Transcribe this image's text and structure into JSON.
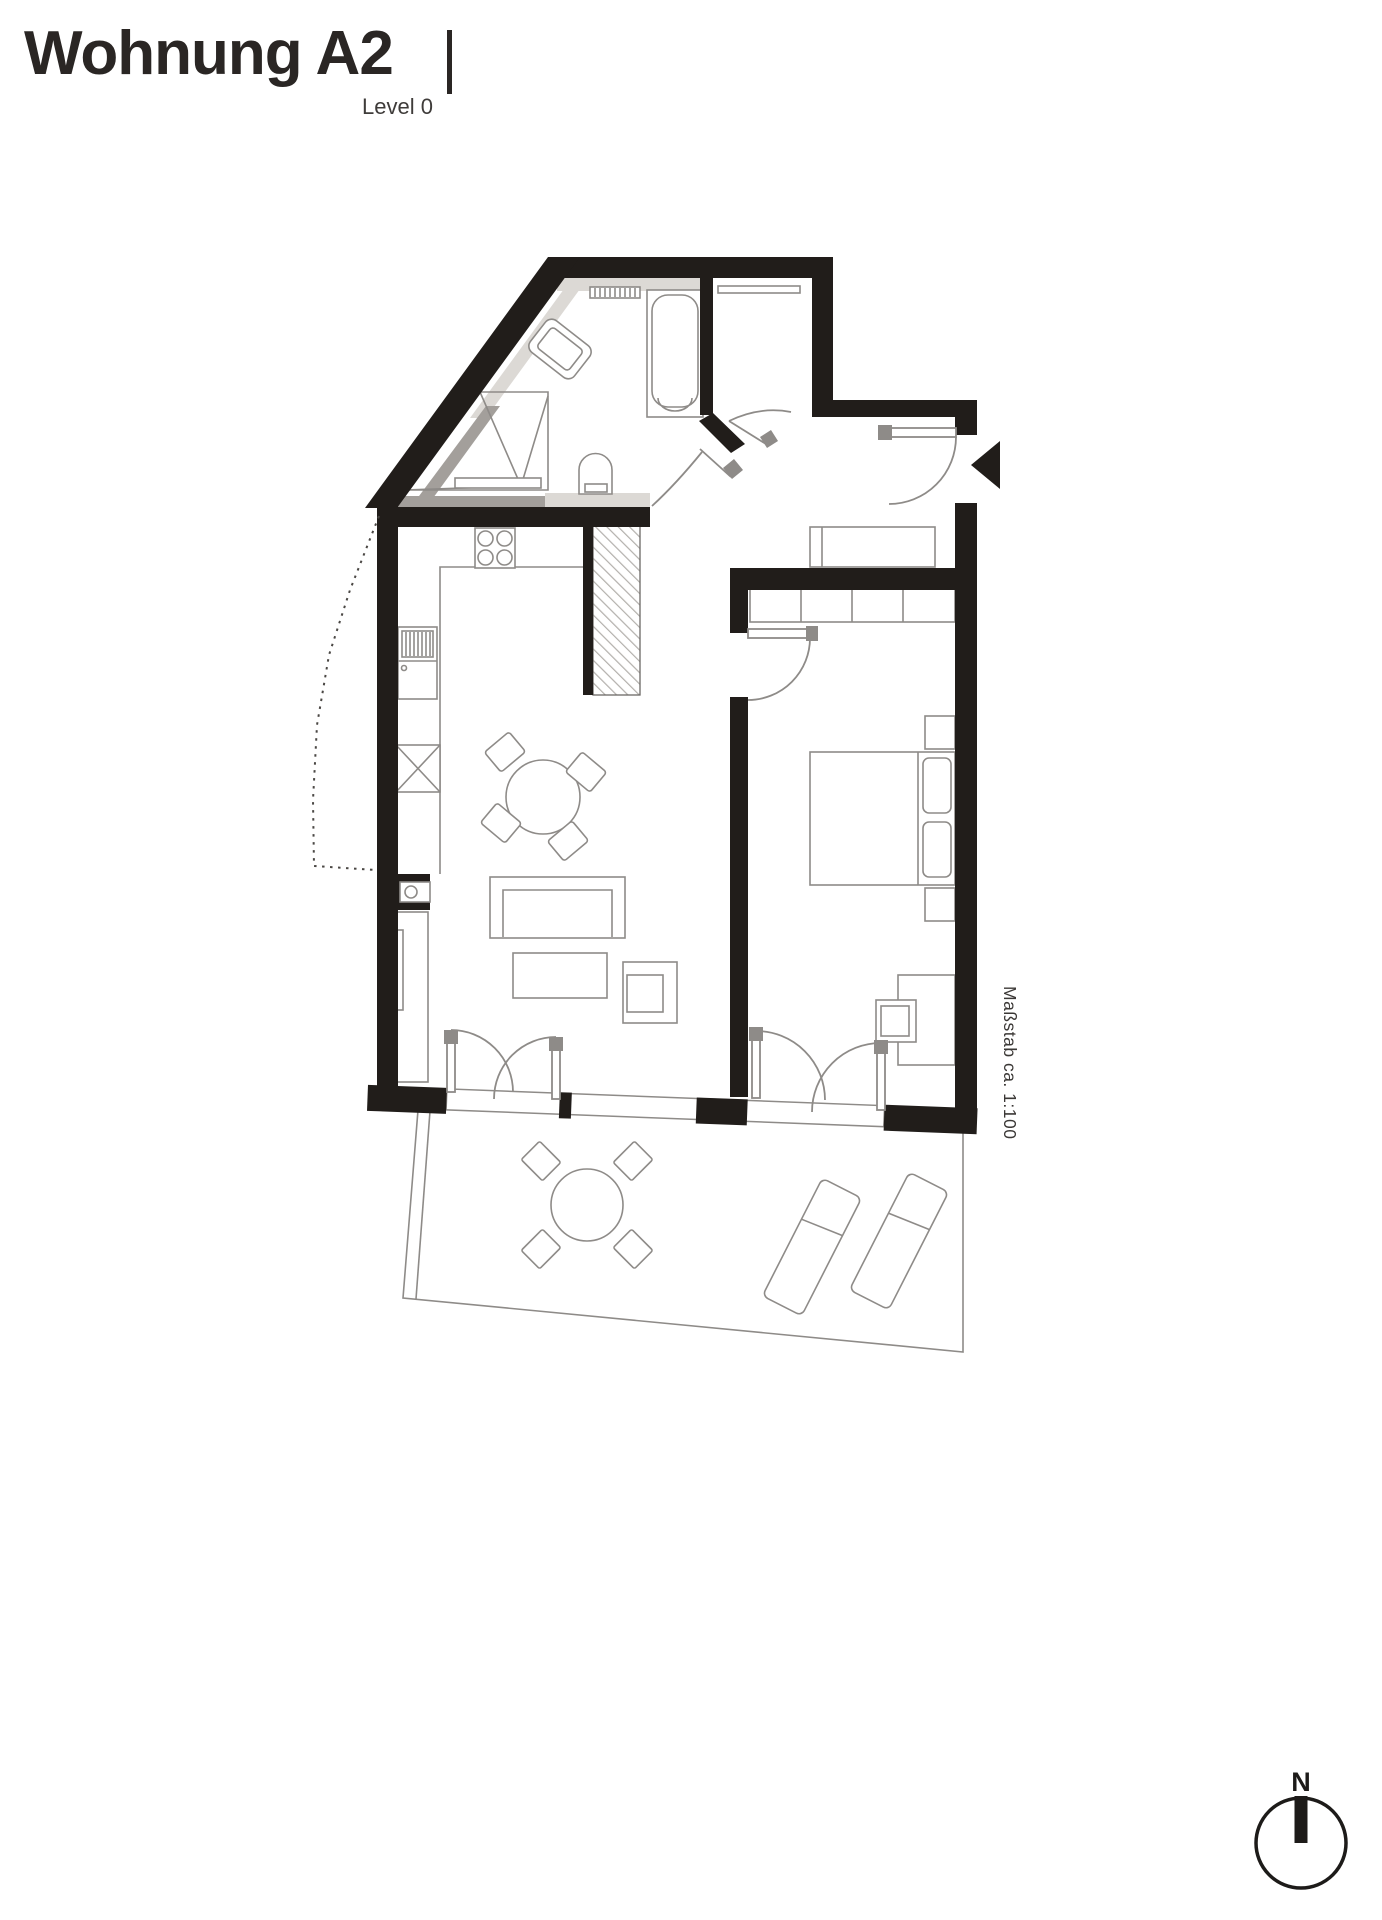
{
  "header": {
    "title": "Wohnung A2",
    "subtitle": "Level 0"
  },
  "plan": {
    "scale_note": "Maßstab ca. 1:100",
    "compass_north_label": "N",
    "colors": {
      "wall": "#211d1a",
      "furniture_line": "#8e8b88",
      "tile_light": "#dcd9d5",
      "tile_medium": "#a39f9b",
      "background": "#ffffff"
    },
    "elements": [
      "bathroom",
      "bathtub",
      "shower",
      "washbasin",
      "washing-machine",
      "towel-radiator",
      "storage-room",
      "coat-rail",
      "hallway",
      "entrance-door",
      "entrance-arrow",
      "sideboard",
      "kitchen",
      "stove",
      "fridge",
      "base-cabinet",
      "installation-shaft",
      "living-room",
      "dining-table",
      "dining-chairs",
      "sofa",
      "coffee-table",
      "armchair",
      "shelf-unit",
      "french-doors",
      "bedroom",
      "wardrobe",
      "double-bed",
      "pillows",
      "nightstands",
      "desk",
      "desk-chair",
      "terrace",
      "terrace-table",
      "terrace-chairs",
      "sun-loungers",
      "property-line",
      "compass"
    ]
  }
}
